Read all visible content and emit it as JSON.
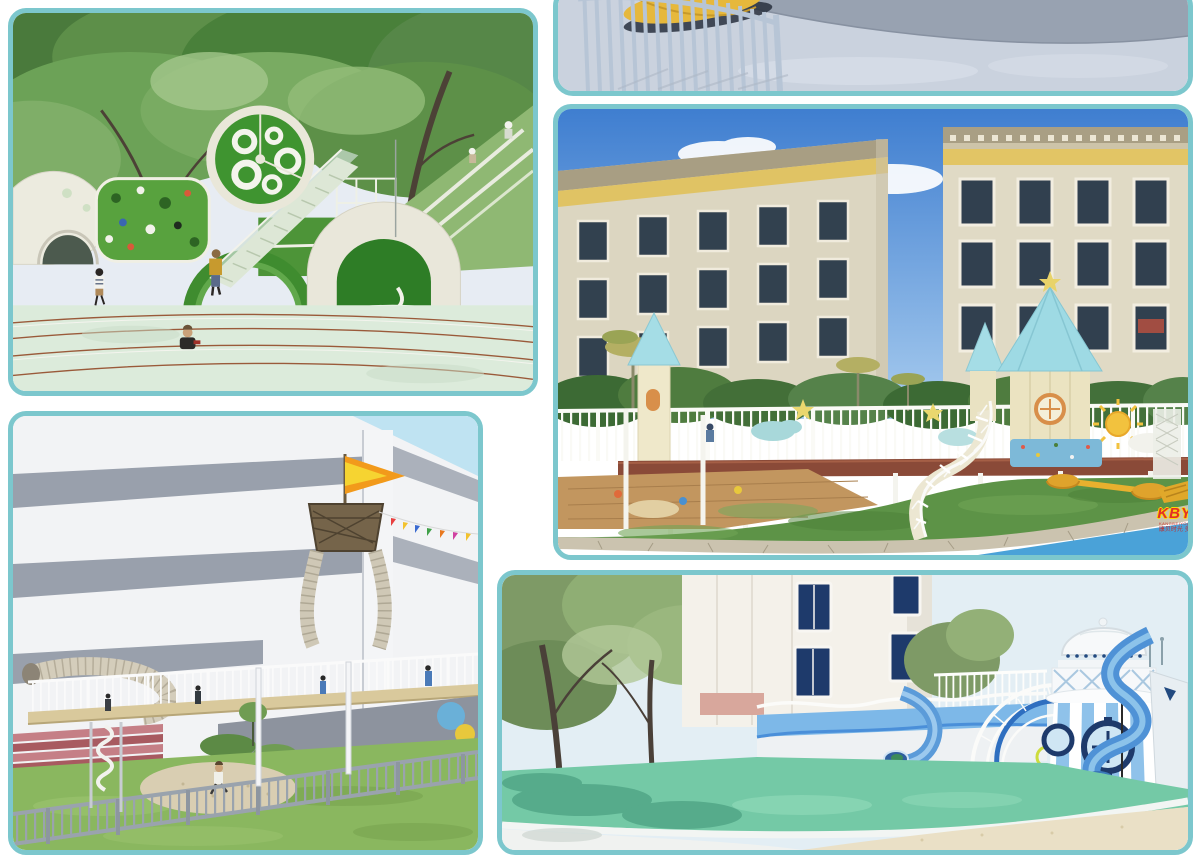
{
  "page": {
    "type": "image-collage",
    "background_color": "#ffffff",
    "frame_color": "#7cc7cd"
  },
  "watermark": {
    "logo": "KBY",
    "tagline_latin": "KANGBEIYOU",
    "tagline_cn": "康贝时光 多",
    "logo_color": "#e23127",
    "logo_outline_color": "#ffd900"
  },
  "gallery": {
    "panels": [
      {
        "id": "green-forest-playground",
        "alt": "Green forest playground render with circular climbing wheel, staircase, arched tunnel, climbing wall and children on a pale green track"
      },
      {
        "id": "paved-yard-corner",
        "alt": "Cropped render of paved yard corner with pale blue railing fence and yellow play boat"
      },
      {
        "id": "courtyard-castle-playground",
        "alt": "Courtyard playground render with pastel castle towers, white railings, spiral staircase, lawn, stone path and beige apartment buildings"
      },
      {
        "id": "ship-adventure-playground",
        "alt": "Ship-mast climbing tower with flag, bunting and net tubes on an elevated walkway in front of a white and grey striped building, lawn and fence below"
      },
      {
        "id": "blue-seaside-playground",
        "alt": "Blue and white seaside themed playground render with dome pavilion, striped rotunda, tube slides, white arches, mint ground and sand"
      }
    ],
    "accent_colors": {
      "playground_green": "#4d9438",
      "pastel_roof_cyan": "#a5dde6",
      "lawn_green": "#5d9347",
      "pool_blue": "#4aa2d8",
      "slide_blue": "#4f92d6",
      "mint_ground": "#74c9a6",
      "flag_orange": "#f29a1b"
    }
  }
}
